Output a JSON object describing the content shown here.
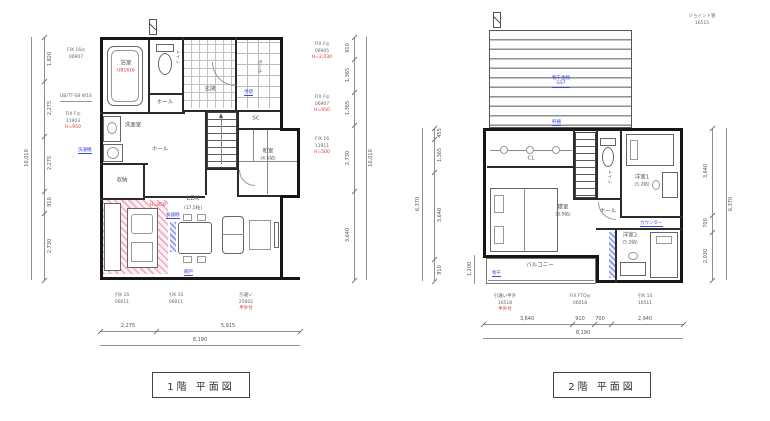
{
  "floor1": {
    "title": "1階 平面図",
    "rooms": {
      "bath": "浴室",
      "bath_code": "UB1616",
      "toilet": "トイレ",
      "wash": "洗面室",
      "entrance": "玄関",
      "porch": "ポーチ",
      "hall_upper": "ホール",
      "hall_lower": "ホール",
      "shoe_closet": "SC",
      "closet": "収納",
      "washitsu": "和室",
      "washitsu_size": "(4.5帖)",
      "ldk": "LDK",
      "ldk_size": "(17.5帖)"
    },
    "dims": {
      "left": [
        "1,820",
        "2,275",
        "2,275",
        "910",
        "2,730"
      ],
      "left_total": "10,010",
      "right": [
        "910",
        "1,365",
        "1,365",
        "2,730",
        "3,640"
      ],
      "right_total": "10,010",
      "bottom": [
        "2,275",
        "5,915"
      ],
      "bottom_total": "8,190",
      "note_left": "UB/TT-SB W16"
    },
    "windows": {
      "left": [
        {
          "code": "FIX 16◎",
          "num": "06907",
          "note": ""
        },
        {
          "code": "FIX F◎",
          "num": "11903",
          "note": "H=950"
        }
      ],
      "right": [
        {
          "code": "FIX F◎",
          "num": "06905",
          "note": "H=2,030"
        },
        {
          "code": "FIX F◎",
          "num": "06907",
          "note": "H=950"
        },
        {
          "code": "FIX 16",
          "num": "11911",
          "note": "H=500"
        }
      ],
      "bottom": [
        {
          "code": "引K 1S",
          "num": "06011",
          "note": ""
        },
        {
          "code": "引K 1S",
          "num": "06011",
          "note": ""
        },
        {
          "code": "引違い",
          "num": "25602",
          "note": "半外付"
        }
      ]
    },
    "notes": {
      "stairs": "手摺",
      "laundry": "洗濯機",
      "cupboard": "食器棚",
      "screen": "網戸",
      "hood": "H=850"
    }
  },
  "floor2": {
    "title": "2階 平面図",
    "rooms": {
      "bedroom": "寝室",
      "bedroom_size": "(8.0帖)",
      "closet": "CL",
      "toilet": "トイレ",
      "hall": "ホール",
      "room1": "洋室1",
      "room1_size": "(5.2帖)",
      "room2": "洋室2",
      "room2_size": "(5.2帖)",
      "balcony": "バルコニー"
    },
    "roof_note": {
      "line1": "物干金物",
      "line2": "GS7"
    },
    "joint": {
      "code": "ジョイント管",
      "num": "16515"
    },
    "dims": {
      "left": [
        "455",
        "1,365",
        "3,640",
        "910"
      ],
      "left_total": "6,370",
      "right": [
        "3,640",
        "700",
        "2,030"
      ],
      "right_total": "6,370",
      "bottom": [
        "3,640",
        "910",
        "700",
        "2,940"
      ],
      "bottom_total": "8,190",
      "balcony": "1,200"
    },
    "windows_bottom": [
      {
        "code": "引違い半外",
        "num": "16518",
        "note": "半外付"
      },
      {
        "code": "FIX FTO◎",
        "num": "06018",
        "note": ""
      },
      {
        "code": "引K 1S",
        "num": "16511",
        "note": ""
      }
    ],
    "notes": {
      "eaves": "軒樋",
      "counter": "カウンター",
      "drying": "物干"
    }
  },
  "colors": {
    "wall": "#161616",
    "dim": "#8f8f8f",
    "blue": "#3b4bd8",
    "red": "#d63333",
    "pink": "#e06a8a"
  }
}
